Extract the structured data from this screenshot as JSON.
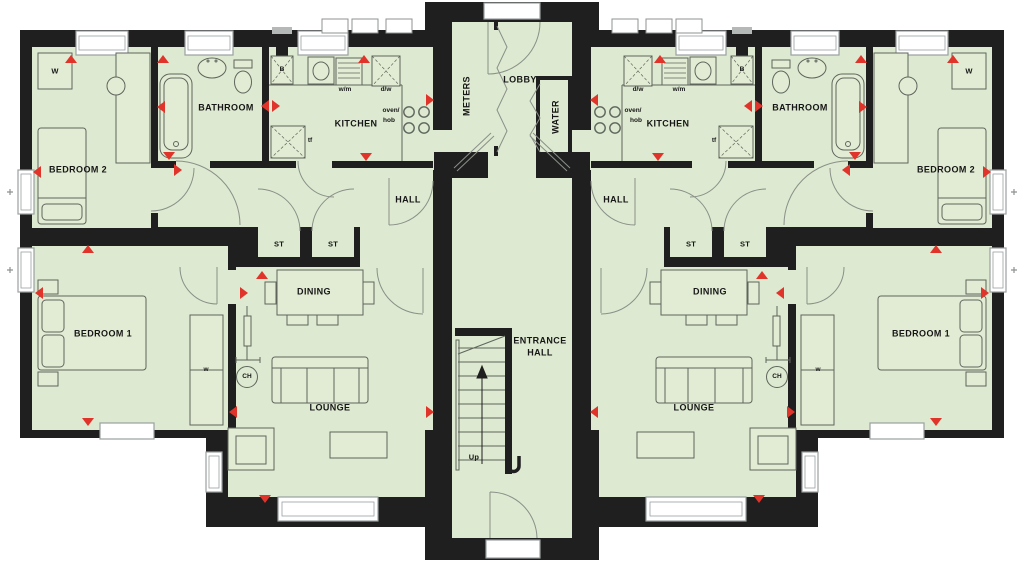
{
  "plan": {
    "type": "floorplan",
    "description": "Symmetrical two-apartment ground floor plan with central lobby and stair core"
  },
  "colors": {
    "floor": "#dde9d0",
    "wall": "#1f1f1f",
    "marker_red": "#e0342b",
    "window_frame": "#9aa0a0",
    "furniture_line": "#5f655c"
  },
  "labels": {
    "bedroom1": "BEDROOM 1",
    "bedroom2": "BEDROOM 2",
    "bathroom": "BATHROOM",
    "kitchen": "KITCHEN",
    "hall": "HALL",
    "storage": "ST",
    "dining": "DINING",
    "lounge": "LOUNGE",
    "meters": "METERS",
    "lobby": "LOBBY",
    "water": "WATER",
    "entrance_line1": "ENTRANCE",
    "entrance_line2": "HALL",
    "up": "Up",
    "wardrobe_large": "W",
    "wardrobe_small": "w",
    "central_heating": "CH",
    "boiler": "B",
    "washing_machine": "w/m",
    "dishwasher": "d/w",
    "oven_line1": "oven/",
    "oven_line2": "hob",
    "tall_fridge": "tf"
  }
}
